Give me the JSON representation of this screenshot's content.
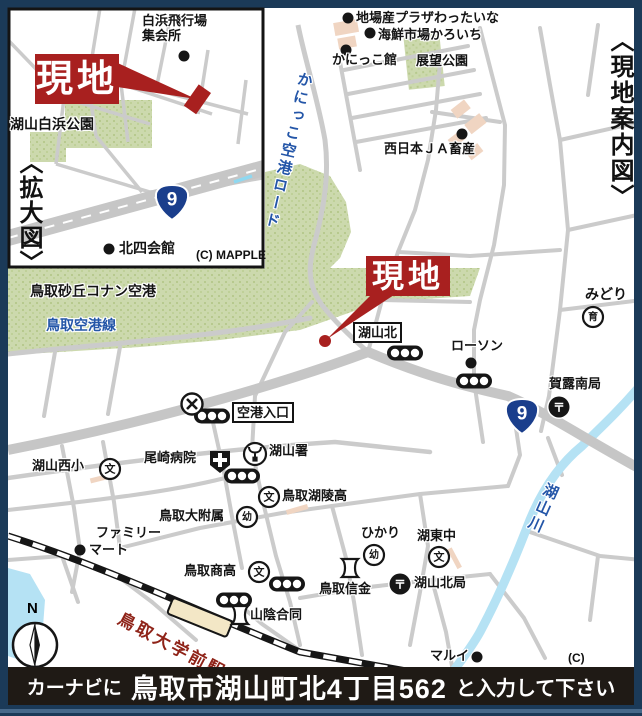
{
  "frame": {
    "vertical_title": "〈現地案内図〉"
  },
  "common": {
    "genchi": "現地",
    "route9": "9",
    "mapple": "(C) MAPPLE",
    "north": "N"
  },
  "inset": {
    "vertical_title": "〈拡大図〉",
    "shirahama_airfield_line1": "白浜飛行場",
    "shirahama_airfield_line2": "集会所",
    "koyama_shirahama_park": "湖山白浜公園",
    "kitayon_hall": "北四会館"
  },
  "main": {
    "jibasan_plaza": "地場産プラザわったいな",
    "kaisen_ichiba": "海鮮市場かろいち",
    "kanikko_kan": "かにっこ館",
    "tenbo_park": "展望公園",
    "nishinihon_ja": "西日本ＪＡ畜産",
    "kanikko_airport_road": "かにっこ空港ロード",
    "conan_airport": "鳥取砂丘コナン空港",
    "airport_line": "鳥取空港線",
    "koyama_kita": "湖山北",
    "lawson": "ローソン",
    "midori": "みどり",
    "karo_minami_post": "賀露南局",
    "airport_entrance": "空港入口",
    "ozaki_hospital": "尾崎病院",
    "koyama_police": "湖山署",
    "koyama_nishi_elem": "湖山西小",
    "koryo_high": "鳥取湖陵高",
    "tottori_fuzoku": "鳥取大附属",
    "family_mart_line1": "ファミリー",
    "family_mart_line2": "マート",
    "shoko_high": "鳥取商高",
    "hikari": "ひかり",
    "koto_junior": "湖東中",
    "tottori_shinkin": "鳥取信金",
    "koyama_kita_post": "湖山北局",
    "sanin_godo": "山陰合同",
    "marui": "マルイ",
    "station_name": "鳥取大学前駅",
    "koyama_river": "湖山川"
  },
  "icons": {
    "school_glyph": "文",
    "kindergarten_glyph": "幼",
    "nursery_glyph": "育",
    "post_glyph": "〒"
  },
  "footer": {
    "navi_prefix": "カーナビに",
    "address": "鳥取市湖山町北4丁目562",
    "navi_suffix": "と入力して下さい"
  }
}
